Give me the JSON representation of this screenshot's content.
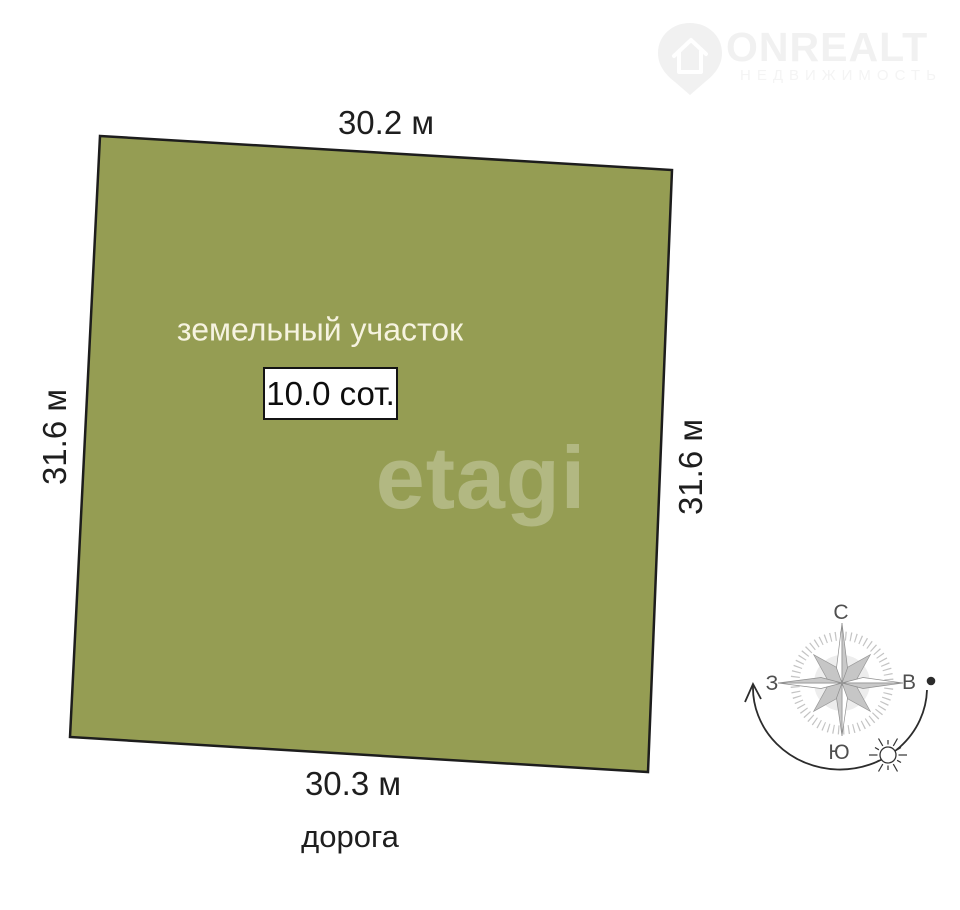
{
  "logo": {
    "brand": "ONREALT",
    "subtitle": "НЕДВИЖИМОСТЬ"
  },
  "plot": {
    "title": "земельный участок",
    "area": "10.0 сот.",
    "fill_color": "#959d53",
    "watermark": "etagi"
  },
  "dimensions": {
    "top": "30.2 м",
    "left": "31.6 м",
    "right": "31.6 м",
    "bottom": "30.3 м"
  },
  "road": "дорога",
  "compass": {
    "north": "С",
    "south": "Ю",
    "west": "З",
    "east": "В"
  }
}
